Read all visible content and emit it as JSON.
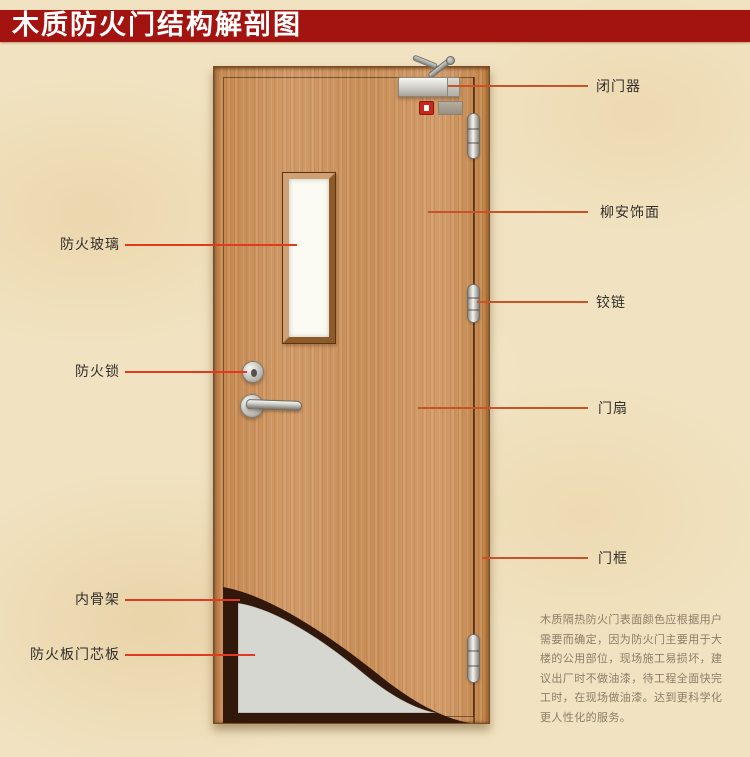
{
  "title": "木质防火门结构解剖图",
  "colors": {
    "banner_red": "#a31310",
    "leader_left_red": "#e23a20",
    "leader_right_red": "#c85328",
    "wood": "#cb915e",
    "inner_frame_dark": "#31180a",
    "core_board_gray": "#d7d7d1",
    "background_beige": "#f1e3c1"
  },
  "labels": {
    "door_closer": "闭门器",
    "veneer": "柳安饰面",
    "hinge": "铰链",
    "door_leaf": "门扇",
    "door_frame": "门框",
    "fire_glass": "防火玻璃",
    "fire_lock": "防火锁",
    "inner_frame": "内骨架",
    "core_board": "防火板门芯板"
  },
  "note": {
    "lines": [
      "木质隔热防火门表面颜色应根据用户",
      "需要而确定，因为防火门主要用于大",
      "楼的公用部位，现场施工易损坏，建",
      "议出厂时不做油漆，待工程全面快完",
      "工时，在现场做油漆。达到更科学化",
      "更人性化的服务。"
    ]
  }
}
